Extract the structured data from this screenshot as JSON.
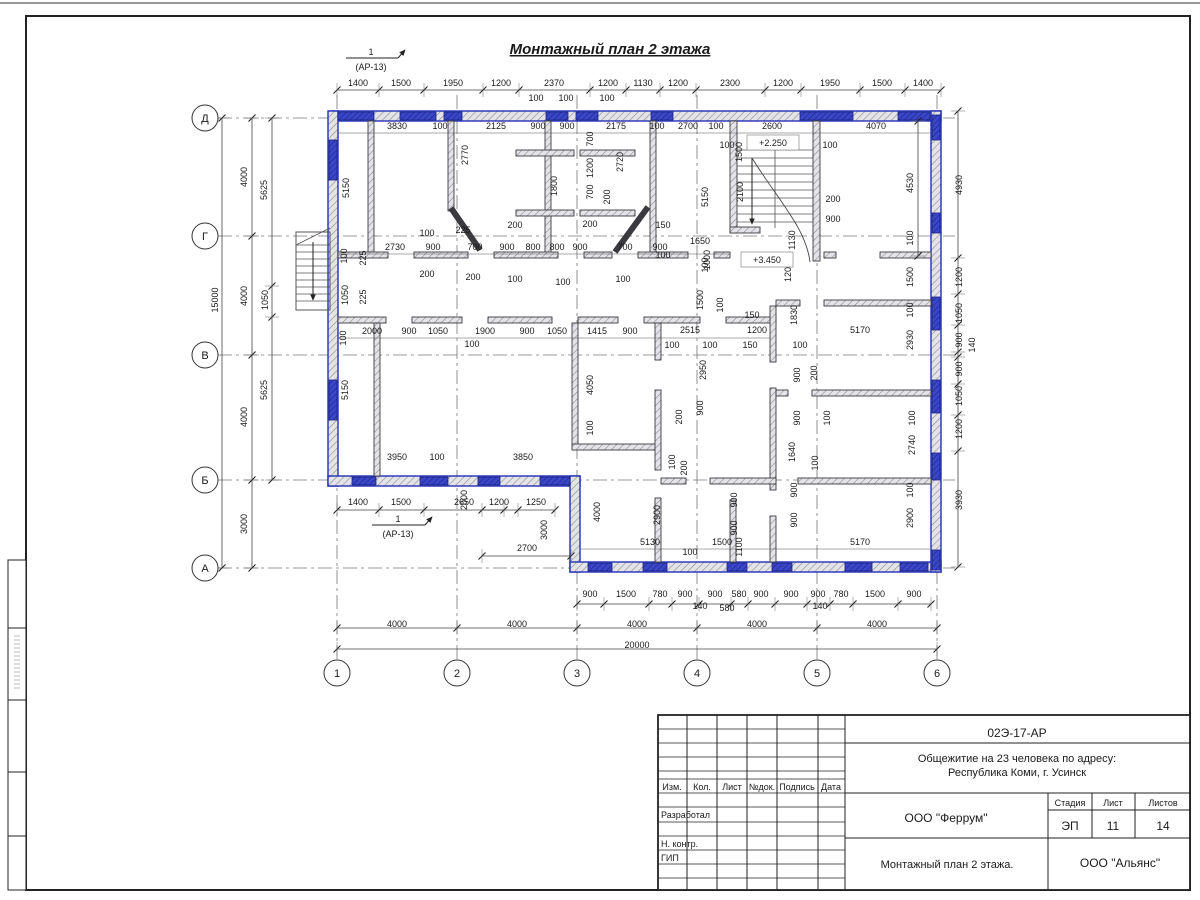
{
  "sheet": {
    "title": "Монтажный план 2 этажа",
    "marker_top": {
      "num": "1",
      "ref": "(АР-13)"
    },
    "marker_bottom": {
      "num": "1",
      "ref": "(АР-13)"
    },
    "axes": {
      "rows": [
        "Д",
        "Г",
        "В",
        "Б",
        "А"
      ],
      "cols": [
        "1",
        "2",
        "3",
        "4",
        "5",
        "6"
      ]
    },
    "levels": [
      {
        "t": "+2.250",
        "x": 773,
        "y": 146
      },
      {
        "t": "+3.450",
        "x": 767,
        "y": 263
      }
    ]
  },
  "dims": [
    [
      "1400",
      358,
      86,
      0
    ],
    [
      "1500",
      401,
      86,
      0
    ],
    [
      "1950",
      453,
      86,
      0
    ],
    [
      "1200",
      501,
      86,
      0
    ],
    [
      "2370",
      554,
      86,
      0
    ],
    [
      "1200",
      608,
      86,
      0
    ],
    [
      "1130",
      643,
      86,
      0
    ],
    [
      "1200",
      678,
      86,
      0
    ],
    [
      "2300",
      730,
      86,
      0
    ],
    [
      "1200",
      783,
      86,
      0
    ],
    [
      "1950",
      830,
      86,
      0
    ],
    [
      "1500",
      882,
      86,
      0
    ],
    [
      "1400",
      923,
      86,
      0
    ],
    [
      "100",
      536,
      101,
      0
    ],
    [
      "100",
      566,
      101,
      0
    ],
    [
      "100",
      607,
      101,
      0
    ],
    [
      "3830",
      397,
      129,
      0
    ],
    [
      "100",
      440,
      129,
      0
    ],
    [
      "2125",
      496,
      129,
      0
    ],
    [
      "900",
      538,
      129,
      0
    ],
    [
      "900",
      567,
      129,
      0
    ],
    [
      "2175",
      616,
      129,
      0
    ],
    [
      "100",
      657,
      129,
      0
    ],
    [
      "2700",
      688,
      129,
      0
    ],
    [
      "100",
      716,
      129,
      0
    ],
    [
      "2600",
      772,
      129,
      0
    ],
    [
      "4070",
      876,
      129,
      0
    ],
    [
      "100",
      727,
      148,
      0
    ],
    [
      "100",
      830,
      148,
      0
    ],
    [
      "2770",
      468,
      155,
      1
    ],
    [
      "5150",
      349,
      188,
      1
    ],
    [
      "5150",
      708,
      197,
      1
    ],
    [
      "1500",
      742,
      152,
      1
    ],
    [
      "2100",
      743,
      192,
      1
    ],
    [
      "1800",
      557,
      186,
      1
    ],
    [
      "700",
      593,
      139,
      1
    ],
    [
      "1200",
      593,
      168,
      1
    ],
    [
      "700",
      593,
      192,
      1
    ],
    [
      "200",
      610,
      197,
      1
    ],
    [
      "2720",
      623,
      162,
      1
    ],
    [
      "225",
      463,
      233,
      0
    ],
    [
      "100",
      427,
      236,
      0
    ],
    [
      "200",
      515,
      228,
      0
    ],
    [
      "200",
      590,
      227,
      0
    ],
    [
      "150",
      663,
      228,
      0
    ],
    [
      "2730",
      395,
      250,
      0
    ],
    [
      "900",
      433,
      250,
      0
    ],
    [
      "700",
      475,
      250,
      0
    ],
    [
      "900",
      507,
      250,
      0
    ],
    [
      "800",
      533,
      250,
      0
    ],
    [
      "800",
      557,
      250,
      0
    ],
    [
      "900",
      580,
      250,
      0
    ],
    [
      "700",
      625,
      250,
      0
    ],
    [
      "900",
      660,
      250,
      0
    ],
    [
      "1650",
      700,
      244,
      0
    ],
    [
      "100",
      663,
      258,
      0
    ],
    [
      "200",
      427,
      277,
      0
    ],
    [
      "200",
      473,
      280,
      0
    ],
    [
      "100",
      515,
      282,
      0
    ],
    [
      "100",
      563,
      285,
      0
    ],
    [
      "100",
      623,
      282,
      0
    ],
    [
      "200",
      833,
      202,
      0
    ],
    [
      "900",
      833,
      222,
      0
    ],
    [
      "225",
      366,
      258,
      1
    ],
    [
      "225",
      366,
      297,
      1
    ],
    [
      "100",
      347,
      256,
      1
    ],
    [
      "1050",
      348,
      295,
      1
    ],
    [
      "100",
      346,
      338,
      1
    ],
    [
      "1050",
      268,
      300,
      1
    ],
    [
      "5625",
      267,
      190,
      1
    ],
    [
      "5625",
      267,
      390,
      1
    ],
    [
      "4000",
      247,
      177,
      1
    ],
    [
      "4000",
      247,
      296,
      1
    ],
    [
      "4000",
      247,
      417,
      1
    ],
    [
      "3000",
      247,
      524,
      1
    ],
    [
      "15000",
      218,
      300,
      1
    ],
    [
      "5150",
      348,
      390,
      1
    ],
    [
      "1130",
      795,
      240,
      1
    ],
    [
      "1200",
      791,
      272,
      1
    ],
    [
      "1000",
      710,
      260,
      1
    ],
    [
      "1500",
      703,
      300,
      1
    ],
    [
      "100",
      723,
      305,
      1
    ],
    [
      "100",
      708,
      265,
      1
    ],
    [
      "2000",
      372,
      334,
      0
    ],
    [
      "900",
      409,
      334,
      0
    ],
    [
      "1050",
      438,
      334,
      0
    ],
    [
      "1900",
      485,
      334,
      0
    ],
    [
      "900",
      527,
      334,
      0
    ],
    [
      "1050",
      557,
      334,
      0
    ],
    [
      "1415",
      597,
      334,
      0
    ],
    [
      "900",
      630,
      334,
      0
    ],
    [
      "2515",
      690,
      333,
      0
    ],
    [
      "100",
      472,
      347,
      0
    ],
    [
      "100",
      672,
      348,
      0
    ],
    [
      "100",
      710,
      348,
      0
    ],
    [
      "150",
      752,
      318,
      0
    ],
    [
      "1200",
      757,
      333,
      0
    ],
    [
      "150",
      750,
      348,
      0
    ],
    [
      "1830",
      797,
      315,
      1
    ],
    [
      "100",
      800,
      348,
      0
    ],
    [
      "5170",
      860,
      333,
      0
    ],
    [
      "2930",
      913,
      340,
      1
    ],
    [
      "100",
      913,
      310,
      1
    ],
    [
      "2950",
      706,
      370,
      1
    ],
    [
      "900",
      703,
      408,
      1
    ],
    [
      "200",
      682,
      417,
      1
    ],
    [
      "900",
      800,
      375,
      1
    ],
    [
      "200",
      817,
      373,
      1
    ],
    [
      "900",
      800,
      418,
      1
    ],
    [
      "100",
      830,
      418,
      1
    ],
    [
      "100",
      675,
      462,
      1
    ],
    [
      "200",
      687,
      468,
      1
    ],
    [
      "4050",
      593,
      385,
      1
    ],
    [
      "100",
      593,
      428,
      1
    ],
    [
      "1640",
      795,
      452,
      1
    ],
    [
      "100",
      818,
      463,
      1
    ],
    [
      "2740",
      915,
      445,
      1
    ],
    [
      "100",
      915,
      418,
      1
    ],
    [
      "4930",
      962,
      185,
      1
    ],
    [
      "1200",
      962,
      277,
      1
    ],
    [
      "1050",
      962,
      313,
      1
    ],
    [
      "900",
      962,
      340,
      1
    ],
    [
      "140",
      975,
      345,
      1
    ],
    [
      "900",
      962,
      369,
      1
    ],
    [
      "1050",
      962,
      396,
      1
    ],
    [
      "1200",
      962,
      429,
      1
    ],
    [
      "3930",
      962,
      500,
      1
    ],
    [
      "4530",
      913,
      183,
      1
    ],
    [
      "100",
      913,
      238,
      1
    ],
    [
      "1500",
      913,
      277,
      1
    ],
    [
      "3950",
      397,
      460,
      0
    ],
    [
      "100",
      437,
      460,
      0
    ],
    [
      "3850",
      523,
      460,
      0
    ],
    [
      "1400",
      358,
      505,
      0
    ],
    [
      "1500",
      401,
      505,
      0
    ],
    [
      "2650",
      464,
      505,
      0
    ],
    [
      "1200",
      499,
      505,
      0
    ],
    [
      "1250",
      536,
      505,
      0
    ],
    [
      "2000",
      467,
      500,
      1
    ],
    [
      "3000",
      547,
      530,
      1
    ],
    [
      "2700",
      527,
      551,
      0
    ],
    [
      "4000",
      600,
      512,
      1
    ],
    [
      "2900",
      660,
      515,
      1
    ],
    [
      "5130",
      650,
      545,
      0
    ],
    [
      "100",
      690,
      555,
      0
    ],
    [
      "1500",
      722,
      545,
      0
    ],
    [
      "1100",
      742,
      547,
      1
    ],
    [
      "900",
      737,
      500,
      1
    ],
    [
      "900",
      737,
      528,
      1
    ],
    [
      "5170",
      860,
      545,
      0
    ],
    [
      "2900",
      913,
      518,
      1
    ],
    [
      "100",
      913,
      490,
      1
    ],
    [
      "900",
      797,
      490,
      1
    ],
    [
      "900",
      797,
      520,
      1
    ],
    [
      "900",
      590,
      597,
      0
    ],
    [
      "1500",
      626,
      597,
      0
    ],
    [
      "780",
      660,
      597,
      0
    ],
    [
      "900",
      685,
      597,
      0
    ],
    [
      "900",
      715,
      597,
      0
    ],
    [
      "580",
      739,
      597,
      0
    ],
    [
      "900",
      761,
      597,
      0
    ],
    [
      "900",
      791,
      597,
      0
    ],
    [
      "900",
      818,
      597,
      0
    ],
    [
      "780",
      841,
      597,
      0
    ],
    [
      "1500",
      875,
      597,
      0
    ],
    [
      "900",
      914,
      597,
      0
    ],
    [
      "140",
      700,
      609,
      0
    ],
    [
      "580",
      727,
      611,
      0
    ],
    [
      "140",
      820,
      609,
      0
    ],
    [
      "4000",
      397,
      627,
      0
    ],
    [
      "4000",
      517,
      627,
      0
    ],
    [
      "4000",
      637,
      627,
      0
    ],
    [
      "4000",
      757,
      627,
      0
    ],
    [
      "4000",
      877,
      627,
      0
    ],
    [
      "20000",
      637,
      648,
      0
    ]
  ],
  "title_block": {
    "doc_number": "02Э-17-АР",
    "project_line1": "Общежитие на 23 человека по адресу:",
    "project_line2": "Республика Коми, г. Усинск",
    "columns": [
      "Изм.",
      "Кол.",
      "Лист",
      "№док.",
      "Подпись",
      "Дата"
    ],
    "row_labels": [
      "Разработал",
      "Н. контр.",
      "ГИП"
    ],
    "org": "ООО \"Феррум\"",
    "stage_label": "Стадия",
    "sheet_label": "Лист",
    "sheets_label": "Листов",
    "stage": "ЭП",
    "sheet_no": "11",
    "sheets_total": "14",
    "drawing_name": "Монтажный план 2 этажа.",
    "contractor": "ООО \"Альянс\""
  },
  "colors": {
    "wall_blue": "#2330b8",
    "window_blue": "#3a46c8",
    "line": "#2b2b2b"
  }
}
